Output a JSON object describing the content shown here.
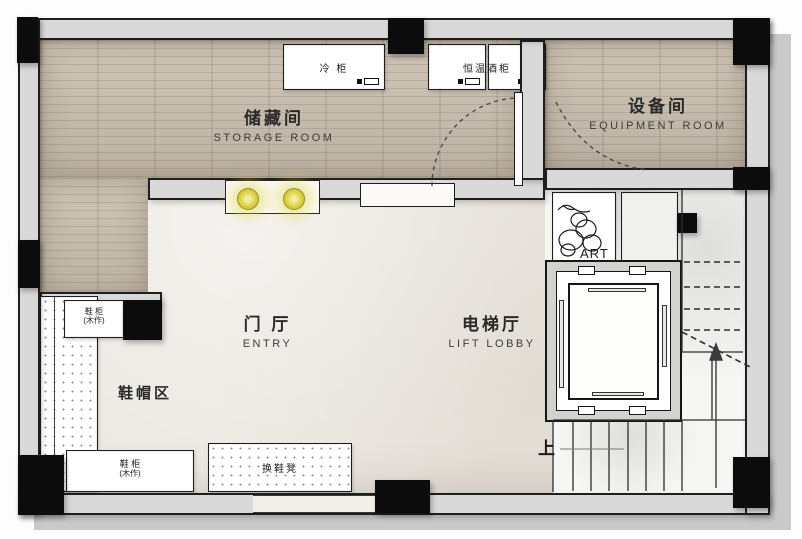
{
  "rooms": {
    "storage": {
      "zh": "储藏间",
      "en": "STORAGE ROOM"
    },
    "equipment": {
      "zh": "设备间",
      "en": "EQUIPMENT ROOM"
    },
    "entry": {
      "zh": "门 厅",
      "en": "ENTRY"
    },
    "lift_lobby": {
      "zh": "电梯厅",
      "en": "LIFT LOBBY"
    },
    "shoe_area": {
      "zh": "鞋帽区"
    }
  },
  "cabinets": {
    "cold_cabinet": "冷 柜",
    "wine_cabinet": "恒温酒柜",
    "shoe_cabinet_upper": "鞋 柜",
    "shoe_cabinet_upper_note": "(木作)",
    "shoe_cabinet_lower": "鞋 柜",
    "shoe_cabinet_lower_note": "(木作)",
    "shoe_bench": "换鞋凳"
  },
  "annotations": {
    "art": "ART",
    "stairs_up": "上"
  },
  "colors": {
    "wall": "#d9d9d9",
    "wall-edge": "#1e1e1e",
    "column": "#0c0c0c",
    "wood": "#c8bdae",
    "marble": "#eae6df",
    "stair-floor": "#f6f6f4",
    "light-glow": "#ded33f",
    "outer": "#c9c9c9"
  }
}
